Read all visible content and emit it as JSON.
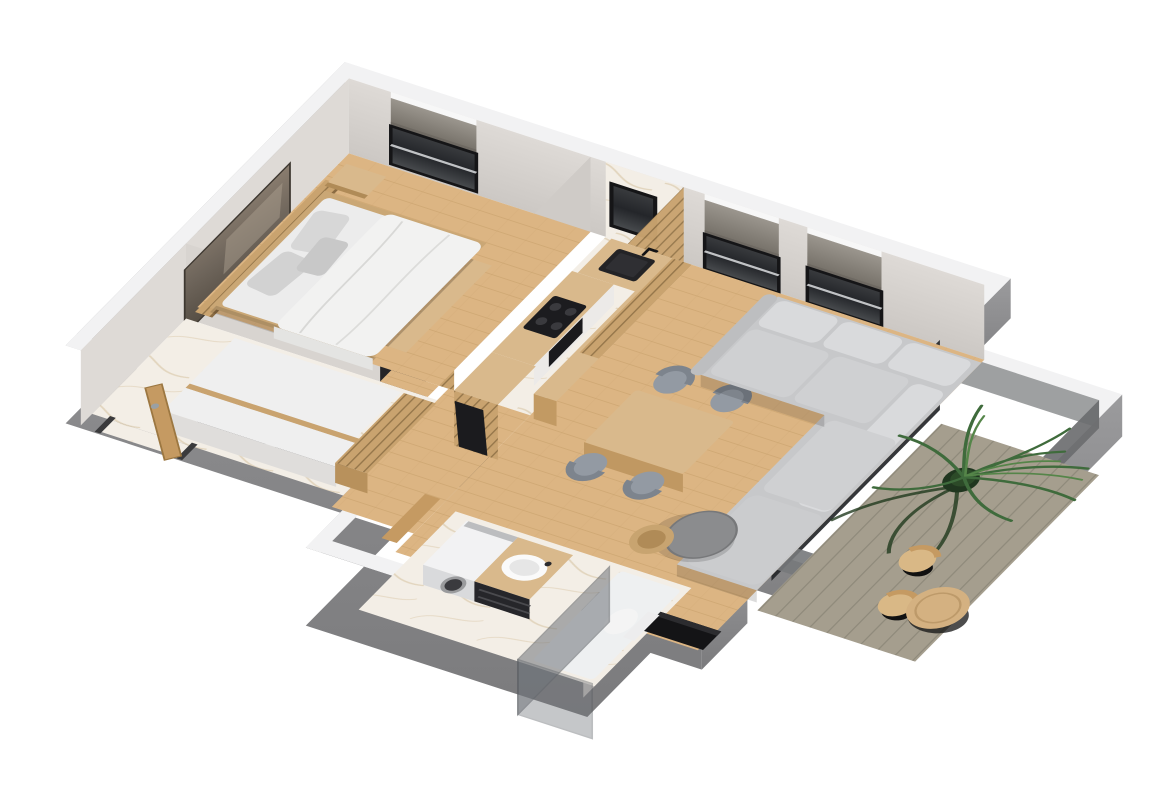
{
  "meta": {
    "title": "3D apartment floor plan rendering",
    "view": "axonometric top-down 3d cutaway",
    "visible_text": "none",
    "background": "#ffffff"
  },
  "palette": {
    "wall_top": "#f2f2f3",
    "wall_ext": "#8e8e90",
    "wall_ext_dark": "#7a7a7c",
    "wall_int": "#d8d4d0",
    "wall_int_dark": "#c8c4c0",
    "floor_wood": "#dcb583",
    "floor_wood_dark": "#c79f6a",
    "marble": "#f3eee6",
    "marble_vein": "#d2bb95",
    "counter_wood": "#d9b98c",
    "slat_wood": "#c9a36f",
    "slat_dark": "#8a6b42",
    "door_wood": "#c59a62",
    "appliance_black": "#1d1d1f",
    "glass_dark": "#2b2d30",
    "window_shade": "#8f8a82",
    "shade_dark": "#6e6962",
    "sofa_gray": "#c7c8ca",
    "sofa_light": "#d9dadc",
    "sofa_dark": "#a9aaad",
    "fabric_gray": "#939aa3",
    "deck_wood": "#a59e8e",
    "deck_gap": "#8a8476",
    "plant_green": "#3f6b3c",
    "plant_light": "#558549",
    "plant_dark": "#203a1e",
    "pot_green": "#20361f",
    "white_furniture": "#efefef",
    "steel": "#9aa0a4",
    "brass": "#d9b36a"
  },
  "scene": {
    "rooms": [
      {
        "name": "bedroom",
        "floor": "wood",
        "furniture": [
          "double-bed",
          "headboard-panel",
          "nightstand",
          "foot-bench",
          "pillows",
          "duvet",
          "wall-artwork",
          "window-roman-shade"
        ]
      },
      {
        "name": "hallway",
        "floor": "marble",
        "furniture": [
          "open-wardrobe",
          "console-cabinet",
          "slat-cabinet",
          "entrance-door"
        ]
      },
      {
        "name": "kitchen",
        "floor": "marble",
        "furniture": [
          "l-shaped-counter",
          "corner-sink",
          "faucet",
          "induction-hob",
          "built-in-oven",
          "tall-fridge-unit",
          "slat-partition",
          "bar-counter",
          "marble-backsplash",
          "kitchen-window"
        ]
      },
      {
        "name": "dining-area",
        "floor": "wood",
        "furniture": [
          "dining-table",
          "dining-chair-1",
          "dining-chair-2",
          "dining-chair-3",
          "dining-chair-4"
        ]
      },
      {
        "name": "living-room",
        "floor": "wood",
        "furniture": [
          "corner-sofa",
          "back-pillows",
          "coffee-table-large",
          "coffee-table-small",
          "media-console",
          "window-roman-shade-1",
          "window-roman-shade-2",
          "balcony-glass-door"
        ]
      },
      {
        "name": "bathroom",
        "floor": "marble",
        "furniture": [
          "washing-machine",
          "vanity-with-round-basin",
          "mirror",
          "shower-glass-enclosure",
          "toilet",
          "leaning-door"
        ]
      },
      {
        "name": "balcony",
        "floor": "deck-planks",
        "furniture": [
          "potted-palm",
          "balcony-chair-1",
          "balcony-chair-2",
          "balcony-round-table",
          "glass-railing"
        ]
      }
    ],
    "windows": [
      {
        "room": "bedroom",
        "wall": "top",
        "shade": "gray-roman"
      },
      {
        "room": "kitchen",
        "wall": "top",
        "shade": "none"
      },
      {
        "room": "living-room",
        "wall": "top",
        "count": 2,
        "shade": "gray-roman"
      }
    ]
  }
}
